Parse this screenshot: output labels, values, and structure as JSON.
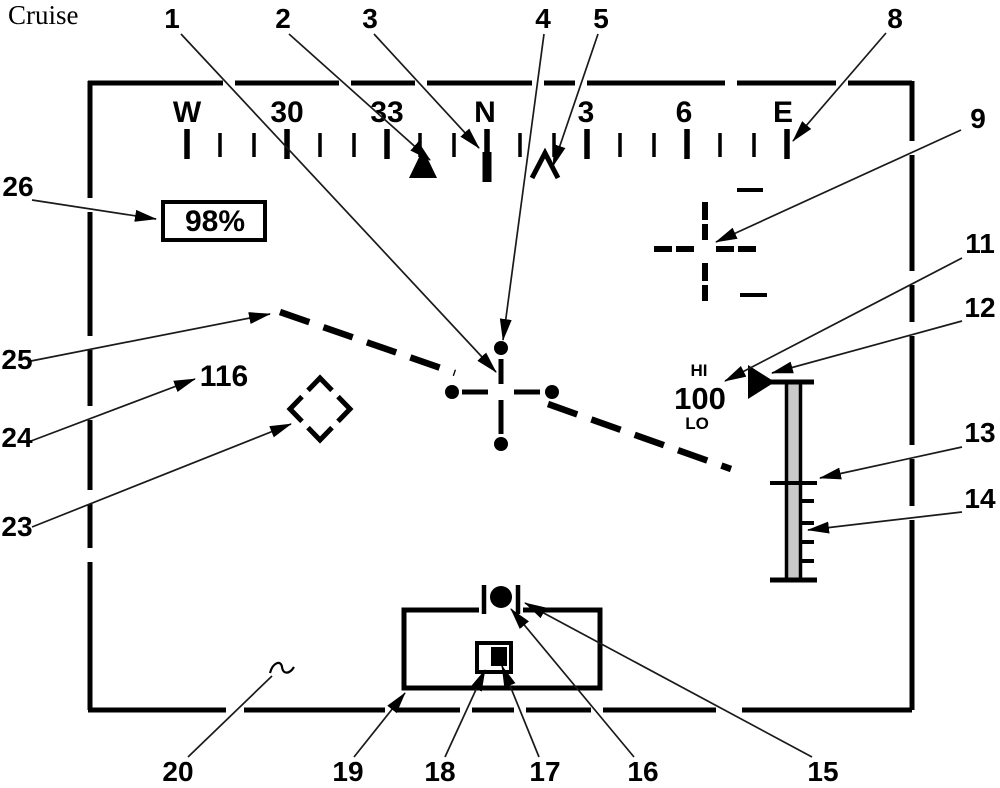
{
  "title": "Cruise",
  "colors": {
    "title_blue": "#2222cc",
    "symbol_black": "#000000",
    "scale_fill": "#c9c9c9"
  },
  "hud": {
    "heading_tape": {
      "labels": [
        "W",
        "30",
        "33",
        "N",
        "3",
        "6",
        "E"
      ]
    },
    "torque_box": {
      "value": "98%"
    },
    "airspeed": {
      "value": "116"
    },
    "altitude_scale": {
      "hi_label": "HI",
      "value": "100",
      "lo_label": "LO"
    }
  },
  "callouts": {
    "c1": "1",
    "c2": "2",
    "c3": "3",
    "c4": "4",
    "c5": "5",
    "c8": "8",
    "c9": "9",
    "c11": "11",
    "c12": "12",
    "c13": "13",
    "c14": "14",
    "c15": "15",
    "c16": "16",
    "c17": "17",
    "c18": "18",
    "c19": "19",
    "c20": "20",
    "c23": "23",
    "c24": "24",
    "c25": "25",
    "c26": "26"
  }
}
